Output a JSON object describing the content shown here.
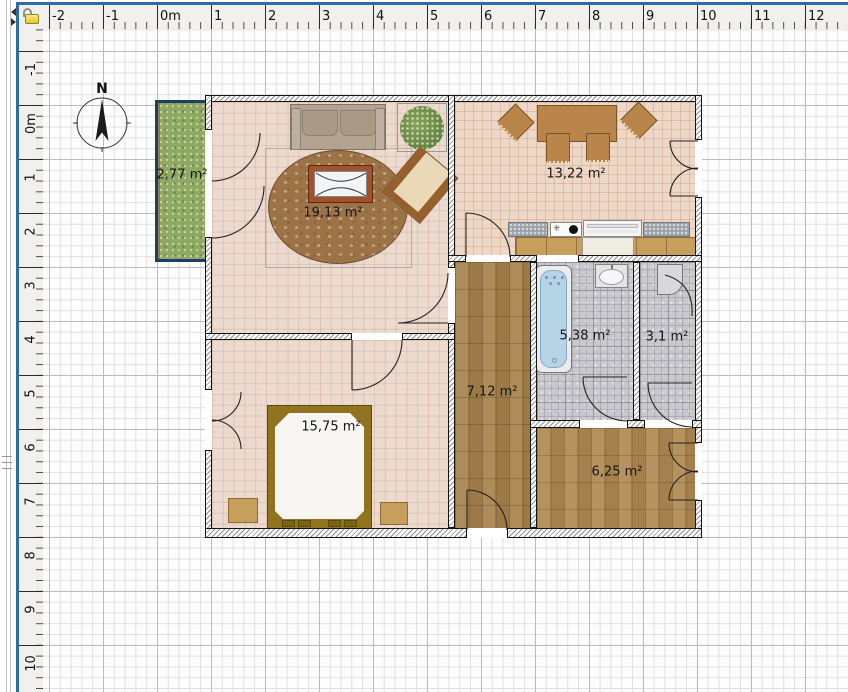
{
  "window": {
    "panel": "floor-plan-editor"
  },
  "rulers": {
    "unit": "m",
    "top_labels": [
      "-2",
      "-1",
      "0m",
      "1",
      "2",
      "3",
      "4",
      "5",
      "6",
      "7",
      "8",
      "9",
      "10",
      "11",
      "12"
    ],
    "left_labels": [
      "-1",
      "0m",
      "1",
      "2",
      "3",
      "4",
      "5",
      "6",
      "7",
      "8",
      "9",
      "10"
    ]
  },
  "compass": {
    "north_label": "N"
  },
  "rooms": [
    {
      "name": "balcony",
      "area": "2,77 m²"
    },
    {
      "name": "living-room",
      "area": "19,13 m²"
    },
    {
      "name": "dining-kitchen",
      "area": "13,22 m²"
    },
    {
      "name": "bathroom",
      "area": "5,38 m²"
    },
    {
      "name": "shower-room",
      "area": "3,1 m²"
    },
    {
      "name": "hallway",
      "area": "7,12 m²"
    },
    {
      "name": "bedroom",
      "area": "15,75 m²"
    },
    {
      "name": "storage-room",
      "area": "6,25 m²"
    }
  ],
  "icons": {
    "corner": "unlocked-padlock-icon",
    "splitter": [
      "collapse-left-icon",
      "collapse-right-icon"
    ]
  },
  "colors": {
    "panel_border": "#2e6da3",
    "grass": "#8fa963",
    "balcony_wall": "#1d3f63",
    "wood_floor": "#a8834e",
    "pink_tile": "#ecdacf",
    "mosaic": "#c9c8cc",
    "bathtub": "#b5d4e7"
  }
}
